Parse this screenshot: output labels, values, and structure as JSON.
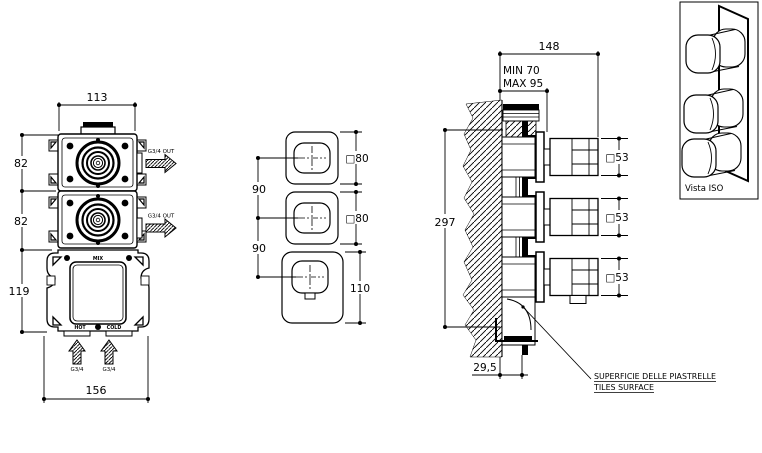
{
  "page": {
    "background": "#ffffff",
    "line_color": "#000000"
  },
  "views": {
    "rough_in_front": {
      "dims": {
        "width_top": "113",
        "module_top": "82",
        "module_mid": "82",
        "body_bottom": "119",
        "width_bottom": "156"
      },
      "labels": {
        "outlet_top": "G3/4 OUT",
        "outlet_mid": "G3/4 OUT",
        "mix": "MIX",
        "hot": "HOT",
        "cold": "COLD",
        "inlet_left": "G3/4",
        "inlet_right": "G3/4"
      }
    },
    "trim_front": {
      "dims": {
        "spacing_top": "90",
        "spacing_bottom": "90",
        "plate_top": "□80",
        "plate_mid": "□80",
        "plate_bottom": "110"
      }
    },
    "section_side": {
      "dims": {
        "depth_total": "148",
        "depth_min": "MIN 70",
        "depth_max": "MAX 95",
        "height_total": "297",
        "tile_offset": "29,5",
        "knob_top": "□53",
        "knob_mid": "□53",
        "knob_bottom": "□53"
      },
      "note": {
        "line1": "SUPERFICIE DELLE PIASTRELLE",
        "line2": "TILES SURFACE"
      }
    },
    "iso": {
      "caption": "Vista ISO"
    }
  }
}
